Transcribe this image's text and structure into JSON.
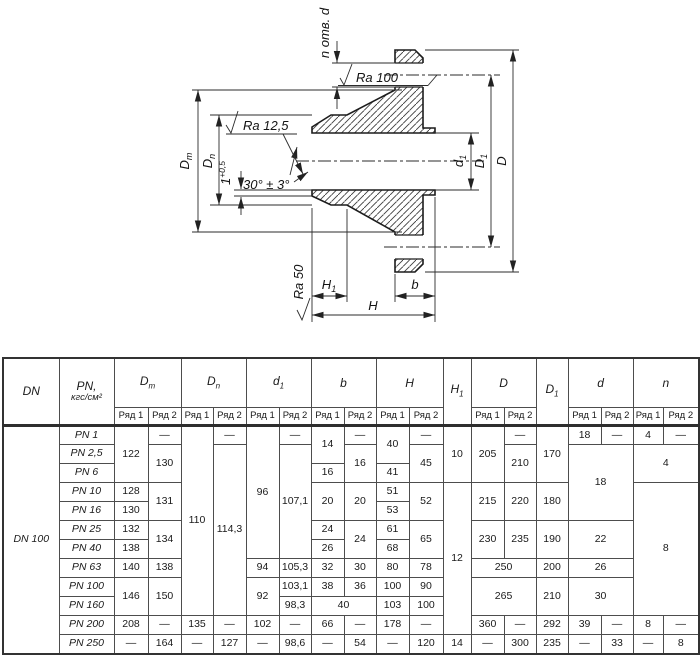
{
  "drawing": {
    "labels": {
      "n_holes": "n отв. d",
      "ra100": "Ra 100",
      "ra125": "Ra 12,5",
      "ra50": "Ra 50",
      "angle": "30° ± 3°",
      "one": {
        "base": "1",
        "sup": "+0,5"
      },
      "dm": {
        "base": "D",
        "sub": "m"
      },
      "dn": {
        "base": "D",
        "sub": "n"
      },
      "d1": {
        "base": "d",
        "sub": "1"
      },
      "dd1": {
        "base": "D",
        "sub": "1"
      },
      "dbig": "D",
      "h": "H",
      "h1": {
        "base": "H",
        "sub": "1"
      },
      "b": "b"
    },
    "line_color": "#1c1c1c"
  },
  "table": {
    "dn_value": "DN 100",
    "header": {
      "dn": "DN",
      "pn_line1": "PN,",
      "pn_line2": "кгс/см²",
      "dm": {
        "base": "D",
        "sub": "m"
      },
      "dn_col": {
        "base": "D",
        "sub": "n"
      },
      "d1": {
        "base": "d",
        "sub": "1"
      },
      "b": "b",
      "h": "H",
      "h1": {
        "base": "H",
        "sub": "1"
      },
      "d_big": "D",
      "d_1": {
        "base": "D",
        "sub": "1"
      },
      "d": "d",
      "n": "n",
      "ryad1": "Ряд 1",
      "ryad2": "Ряд 2"
    },
    "body": [
      [
        "PN 1",
        "122",
        "—",
        "110",
        "—",
        "96",
        "—",
        "14",
        "—",
        "40",
        "—",
        "10",
        "205",
        "—",
        "170",
        "18",
        "—",
        "4",
        "—"
      ],
      [
        "PN 2,5",
        "130",
        "114,3",
        "107,1",
        "16",
        "45",
        "210",
        "18",
        "4"
      ],
      [
        "PN 6",
        "16",
        "41"
      ],
      [
        "PN 10",
        "128",
        "131",
        "20",
        "20",
        "51",
        "52",
        "12",
        "215",
        "220",
        "180",
        "8"
      ],
      [
        "PN 16",
        "130",
        "53"
      ],
      [
        "PN 25",
        "132",
        "134",
        "24",
        "24",
        "61",
        "65",
        "230",
        "235",
        "190",
        "22"
      ],
      [
        "PN 40",
        "138",
        "26",
        "68"
      ],
      [
        "PN 63",
        "140",
        "138",
        "94",
        "105,3",
        "32",
        "30",
        "80",
        "78",
        "250",
        "200",
        "26"
      ],
      [
        "PN 100",
        "146",
        "150",
        "92",
        "103,1",
        "38",
        "36",
        "100",
        "90",
        "265",
        "210",
        "30"
      ],
      [
        "PN 160",
        "98,3",
        "40",
        "103",
        "100"
      ],
      [
        "PN 200",
        "208",
        "—",
        "135",
        "—",
        "102",
        "—",
        "66",
        "—",
        "178",
        "—",
        "360",
        "—",
        "292",
        "39",
        "—",
        "8",
        "—"
      ],
      [
        "PN 250",
        "—",
        "164",
        "—",
        "127",
        "—",
        "98,6",
        "—",
        "54",
        "—",
        "120",
        "14",
        "—",
        "300",
        "235",
        "—",
        "33",
        "—",
        "8"
      ]
    ]
  }
}
